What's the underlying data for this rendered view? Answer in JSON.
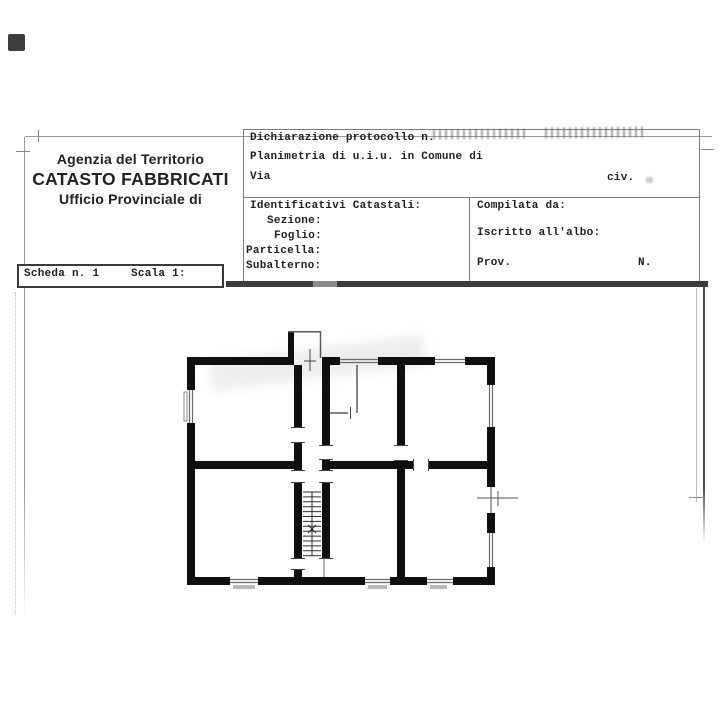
{
  "header": {
    "line1": "Agenzia del Territorio",
    "line2": "CATASTO FABBRICATI",
    "line3": "Ufficio Provinciale di"
  },
  "form": {
    "declaration_label": "Dichiarazione protocollo n.",
    "planimetry_label": "Planimetria di u.i.u. in Comune di",
    "street_label": "Via",
    "civic_label": "civ.",
    "cadastral_ids_label": "Identificativi Catastali:",
    "section_label": "Sezione:",
    "sheet_label": "Foglio:",
    "parcel_label": "Particella:",
    "subaltern_label": "Subalterno:",
    "compiled_by_label": "Compilata da:",
    "register_label": "Iscritto all'albo:",
    "province_label": "Prov.",
    "number_label": "N."
  },
  "scheda": {
    "sheet_number_label": "Scheda n. 1",
    "scale_label": "Scala 1:"
  },
  "colors": {
    "wall_black": "#0f0f0f",
    "thin_line_gray": "#6a6a6a",
    "thick_rule_gray": "#3c3c3c",
    "border_gray": "#9a9a9a",
    "text_ink": "#1f1f1f",
    "window_sill_gray": "#b8b8b8",
    "paper": "#ffffff"
  }
}
